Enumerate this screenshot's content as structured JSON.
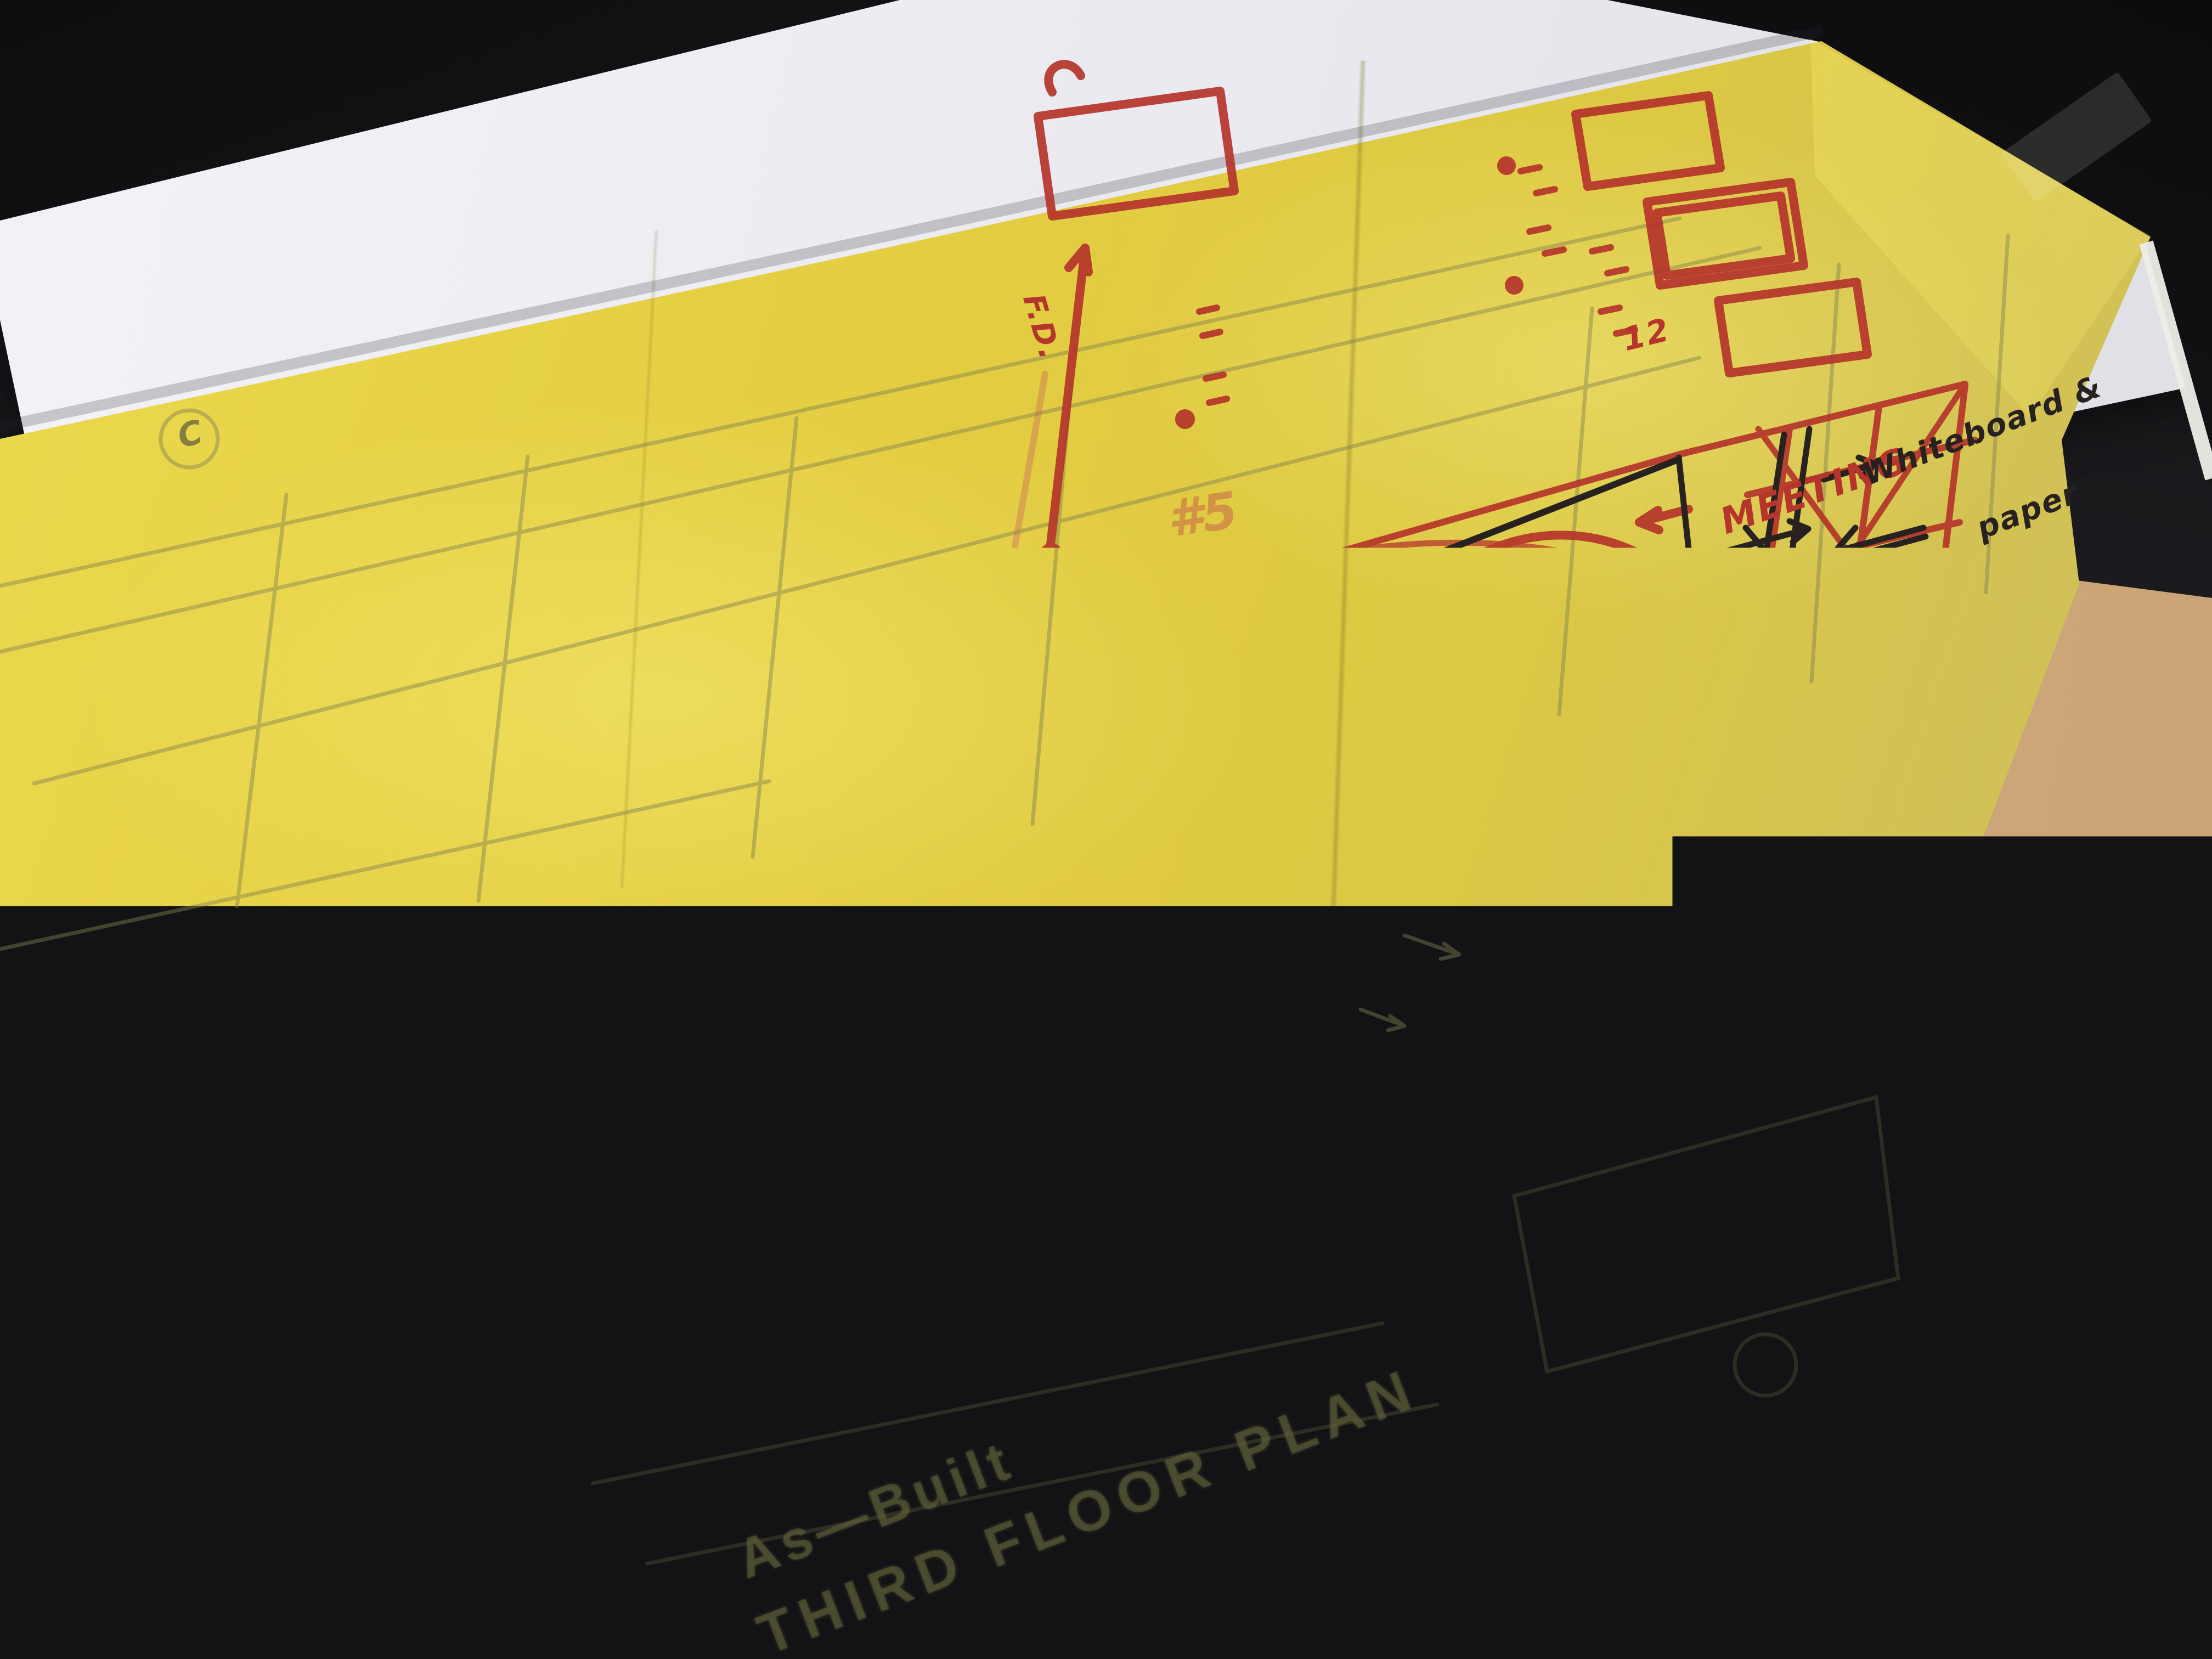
{
  "photo": {
    "description": "hand-marked architectural trace overlay on as-built plan",
    "underlay_plan": {
      "grid_bubble": "C",
      "room_label_lounge": "/LOUNGE",
      "room_label_lounge_sub": "B",
      "room_label_office": "OFFICE",
      "pencil_note_qm": "Q&M",
      "pencil_note_staff": "+ STAFF",
      "pencil_note_scs": "SCS",
      "pencil_note_uh": "UH",
      "pencil_note_cs": "CS",
      "title_line_1": "As—Built",
      "title_line_2": "THIRD FLOOR PLAN",
      "sheet_number": "6",
      "faded_red_note": "#5"
    },
    "black_ink": {
      "new_label": "new/",
      "conf_label": "CONF",
      "main_label": "MAIN",
      "main_conf_label": "CONF",
      "it_label": "IT",
      "ser_label": "SER",
      "corp_pantry": "CORP. PANTRY/",
      "forming_storming": "FORMING/STORMING",
      "records": "RECORDS?",
      "whiteboard_line1": "Whiteboard &",
      "whiteboard_line2": "paper",
      "cask": "CASK",
      "cok": "COK",
      "bd_small": "BD"
    },
    "red_marker": {
      "ses": "SES",
      "ser_big": "SER",
      "bd_big": "BD",
      "meeting": "MEETING",
      "fd": "F.D.",
      "table_count": "12"
    },
    "colors": {
      "trace_yellow": "#e3d14d",
      "marker_red": "#b5352c",
      "pen_black": "#27221f",
      "pencil_olive": "#76764e",
      "desk_dark": "#1c1c1f"
    }
  }
}
